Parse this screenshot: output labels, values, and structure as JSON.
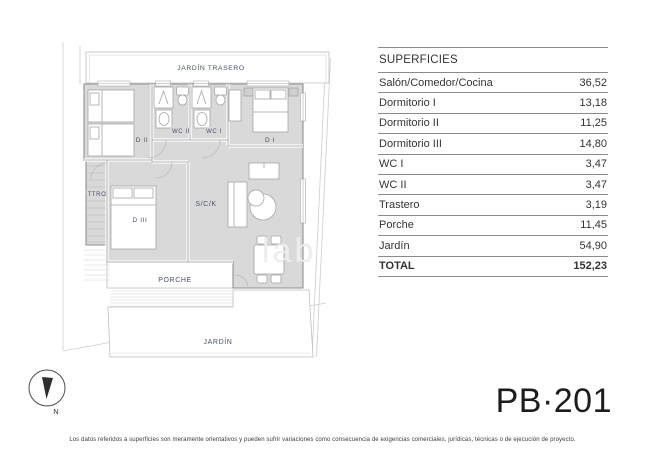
{
  "document": {
    "plan_code": "PB·201",
    "disclaimer": "Los datos referidos a superficies son meramente orientativos y pueden sufrir variaciones como consecuencia de exigencias comerciales, jurídicas, técnicas o de ejecución de proyecto."
  },
  "plan": {
    "labels": {
      "jardin_trasero": "JARDÍN TRASERO",
      "dormitorio_1": "D I",
      "dormitorio_2": "D II",
      "dormitorio_3": "D III",
      "wc_1": "WC I",
      "wc_2": "WC II",
      "trastero": "TTRO",
      "salon_comedor_cocina": "S/C/K",
      "porche": "PORCHE",
      "jardin": "JARDÍN",
      "north": "N"
    },
    "colors": {
      "room_fill": "#d9d9d9",
      "wall_line": "#8f8f8f",
      "label_text": "#4a5268",
      "boundary_line": "#cdcdcd"
    }
  },
  "surfaces_table": {
    "title": "SUPERFICIES",
    "rows": [
      {
        "label": "Salón/Comedor/Cocina",
        "value": "36,52"
      },
      {
        "label": "Dormitorio I",
        "value": "13,18"
      },
      {
        "label": "Dormitorio II",
        "value": "11,25"
      },
      {
        "label": "Dormitorio III",
        "value": "14,80"
      },
      {
        "label": "WC I",
        "value": "3,47"
      },
      {
        "label": "WC II",
        "value": "3,47"
      },
      {
        "label": "Trastero",
        "value": "3,19"
      },
      {
        "label": "Porche",
        "value": "11,45"
      },
      {
        "label": "Jardín",
        "value": "54,90"
      }
    ],
    "total": {
      "label": "TOTAL",
      "value": "152,23"
    }
  }
}
